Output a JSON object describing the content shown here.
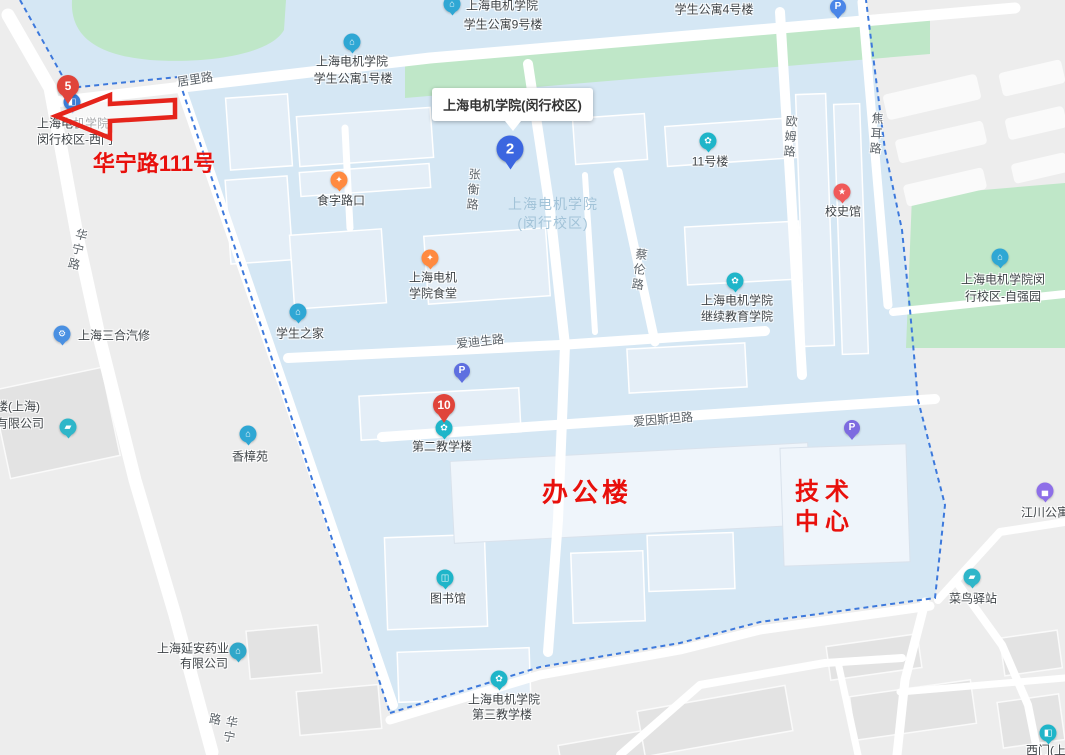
{
  "colors": {
    "campus_fill": "#d5e7f4",
    "outside_fill": "#ededed",
    "green": "#bfe7c8",
    "road": "#ffffff",
    "boundary_dash": "#3d79dc",
    "red_annotation": "#e8100c",
    "marker_red": "#e0443a",
    "marker_blue": "#3b66e0",
    "poi_teal": "#1fb5c9",
    "poi_blue": "#2fa7d4",
    "poi_orange": "#ff8a40",
    "poi_purple": "#8e6fe8"
  },
  "icons": {
    "building": "⌂",
    "food": "✦",
    "home": "⌂",
    "star": "★",
    "leaf": "✿",
    "book": "◫",
    "parking": "P",
    "gear": "⚙",
    "truck": "▰",
    "bed": "▄",
    "gate": "◧"
  },
  "callout": {
    "title": "上海电机学院(闵行校区)"
  },
  "watermark": {
    "line1": "上海电机学院",
    "line2": "(闵行校区)"
  },
  "markers": {
    "m5": "5",
    "m2": "2",
    "m10": "10"
  },
  "annotations": {
    "address": "华宁路111号",
    "office": "办公楼",
    "tech_line1": "技术",
    "tech_line2": "中心"
  },
  "roads": {
    "juli": "居里路",
    "zhangheng": "张衡路",
    "cailun": "蔡伦路",
    "oumu": "欧姆路",
    "jiaoer": "焦耳路",
    "aidisheng": "爱迪生路",
    "aiyinsitan": "爱因斯坦路",
    "huaning_north": "华宁路",
    "huaning_south": "华宁路"
  },
  "pois": {
    "west_gate": {
      "line1": "上海电机学院",
      "line2": "闵行校区-西门"
    },
    "dorm9": {
      "line1": "上海电机学院",
      "line2": "学生公寓9号楼"
    },
    "dorm1": {
      "line1": "上海电机学院",
      "line2": "学生公寓1号楼"
    },
    "dorm4": {
      "label": "学生公寓4号楼"
    },
    "bldg11": {
      "label": "11号楼"
    },
    "xiaoshiguan": {
      "label": "校史馆"
    },
    "ziqiangyuan": {
      "line1": "上海电机学院闵",
      "line2": "行校区-自强园"
    },
    "shizilukou": {
      "label": "食字路口"
    },
    "shitang": {
      "line1": "上海电机",
      "line2": "学院食堂"
    },
    "xueshengzhijia": {
      "label": "学生之家"
    },
    "jixujiaoyu": {
      "line1": "上海电机学院",
      "line2": "继续教育学院"
    },
    "dierjiaoxuelou": {
      "label": "第二教学楼"
    },
    "sanheqixiu": {
      "label": "上海三合汽修"
    },
    "honglou": {
      "line1": "红楼(上海)",
      "line2": "递有限公司"
    },
    "xiangzhangyuan": {
      "label": "香樟苑"
    },
    "yananyaoye": {
      "line1": "上海延安药业",
      "line2": "有限公司"
    },
    "tushuguan": {
      "label": "图书馆"
    },
    "disanjiaoxuelou": {
      "line1": "上海电机学院",
      "line2": "第三教学楼"
    },
    "jiangchuan": {
      "label": "江川公寓"
    },
    "cainiao": {
      "label": "菜鸟驿站"
    },
    "ximen": {
      "label": "西门(上"
    }
  }
}
